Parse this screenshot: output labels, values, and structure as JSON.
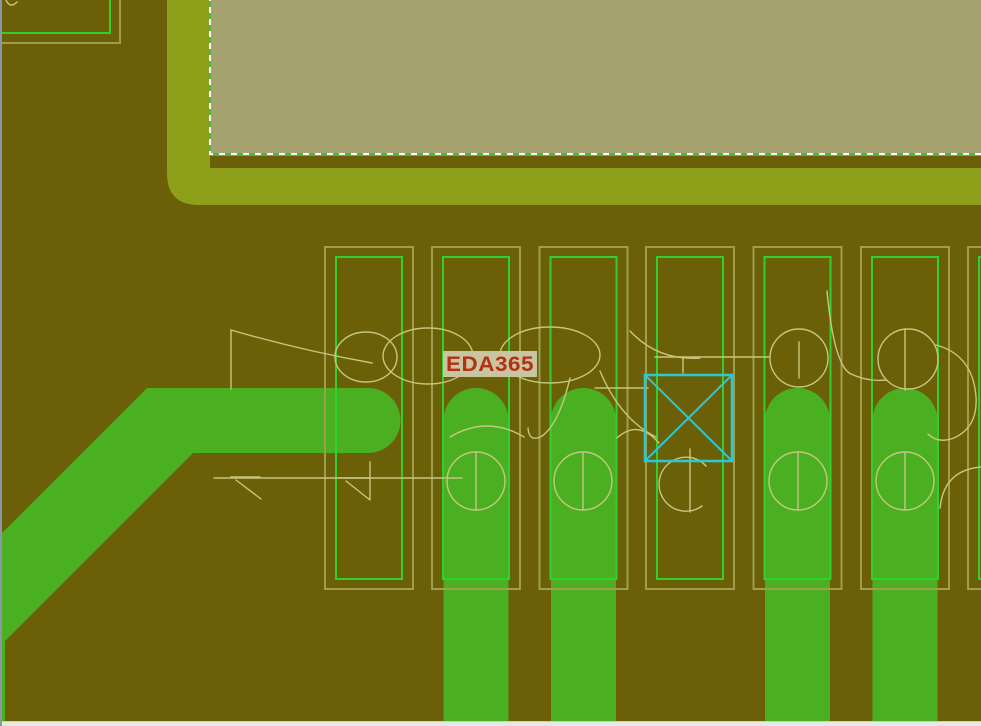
{
  "canvas": {
    "width_px": 981,
    "height_px": 726,
    "view": "pcb-routing-layer"
  },
  "label": {
    "text": "EDA365"
  },
  "board": {
    "pad_count": 7,
    "routed_trace_count": 5,
    "unrouted_pin_marker": "cyan-crossed-square",
    "plane_outline_style": "white-green-dashed"
  },
  "colors": {
    "background": "#6b6008",
    "plane_band": "#8ea019",
    "board_fill": "#a5a26f",
    "dash_green": "#42bb42",
    "dash_white": "#ffffff",
    "pad_outer_outline": "#9e9e4c",
    "pad_inner_outline": "#30d030",
    "trace": "#4ab022",
    "silkscreen": "#c6c67e",
    "marker_cyan": "#2cc8d4",
    "label_text": "#b43116",
    "label_bg": "#c9c5a0",
    "window_edge": "#8d97a3",
    "window_strip": "#e9e9e4",
    "window_strip_line": "#c3cdd6"
  }
}
